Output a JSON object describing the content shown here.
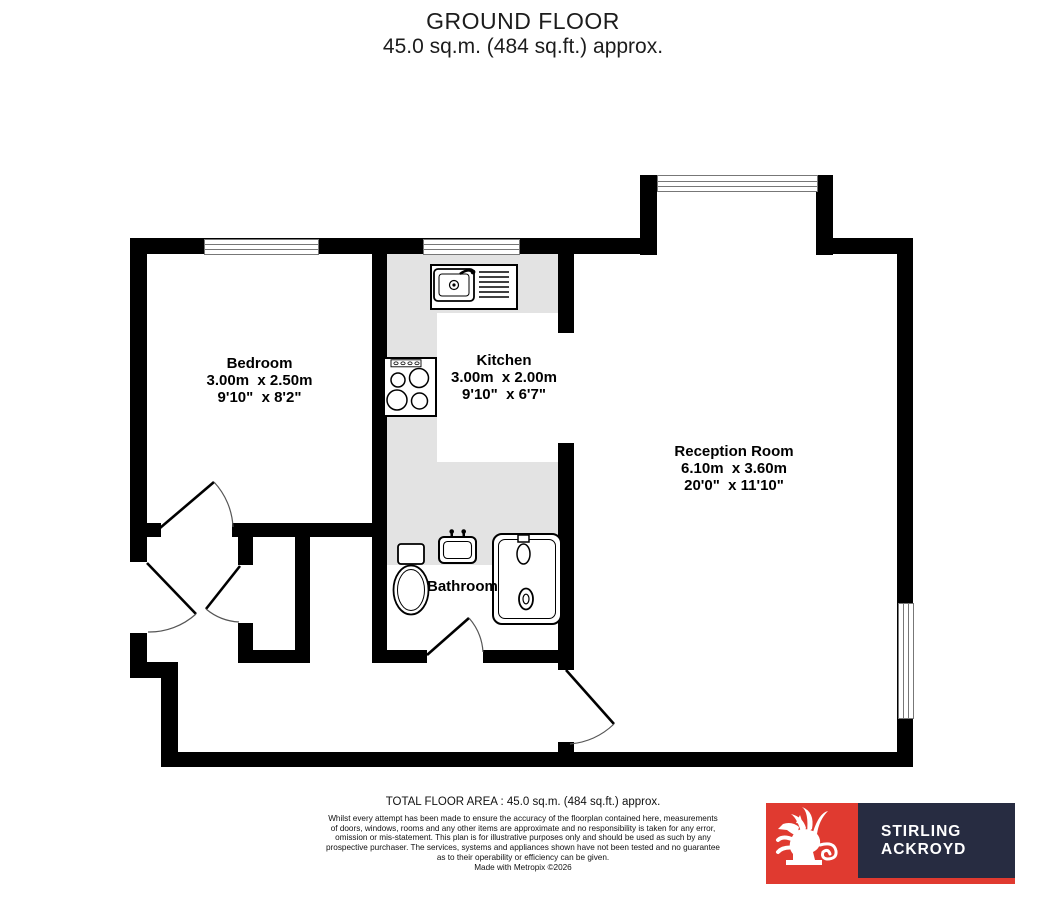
{
  "title": {
    "line1": "GROUND FLOOR",
    "line2": "45.0 sq.m. (484 sq.ft.) approx."
  },
  "rooms": {
    "bedroom": {
      "name": "Bedroom",
      "metric": "3.00m  x 2.50m",
      "imperial": "9'10\"  x 8'2\""
    },
    "kitchen": {
      "name": "Kitchen",
      "metric": "3.00m  x 2.00m",
      "imperial": "9'10\"  x 6'7\""
    },
    "reception": {
      "name": "Reception Room",
      "metric": "6.10m  x 3.60m",
      "imperial": "20'0\"  x 11'10\""
    },
    "bathroom": {
      "name": "Bathroom"
    }
  },
  "footer": {
    "total_area": "TOTAL FLOOR AREA : 45.0 sq.m. (484 sq.ft.) approx.",
    "disclaimer_lines": [
      "Whilst every attempt has been made to ensure the accuracy of the floorplan contained here, measurements",
      "of doors, windows, rooms and any other items are approximate and no responsibility is taken for any error,",
      "omission or mis-statement. This plan is for illustrative purposes only and should be used as such by any",
      "prospective purchaser. The services, systems and appliances shown have not been tested and no guarantee",
      "as to their operability or efficiency can be given."
    ],
    "credit": "Made with Metropix ©2026"
  },
  "logo": {
    "name_line1": "STIRLING",
    "name_line2": "ACKROYD",
    "griffin_icon": "griffin"
  },
  "colors": {
    "wall": "#000000",
    "floor_gray": "#E3E3E3",
    "window_line": "#777777",
    "brand_red": "#E03A30",
    "brand_navy": "#272C41"
  }
}
